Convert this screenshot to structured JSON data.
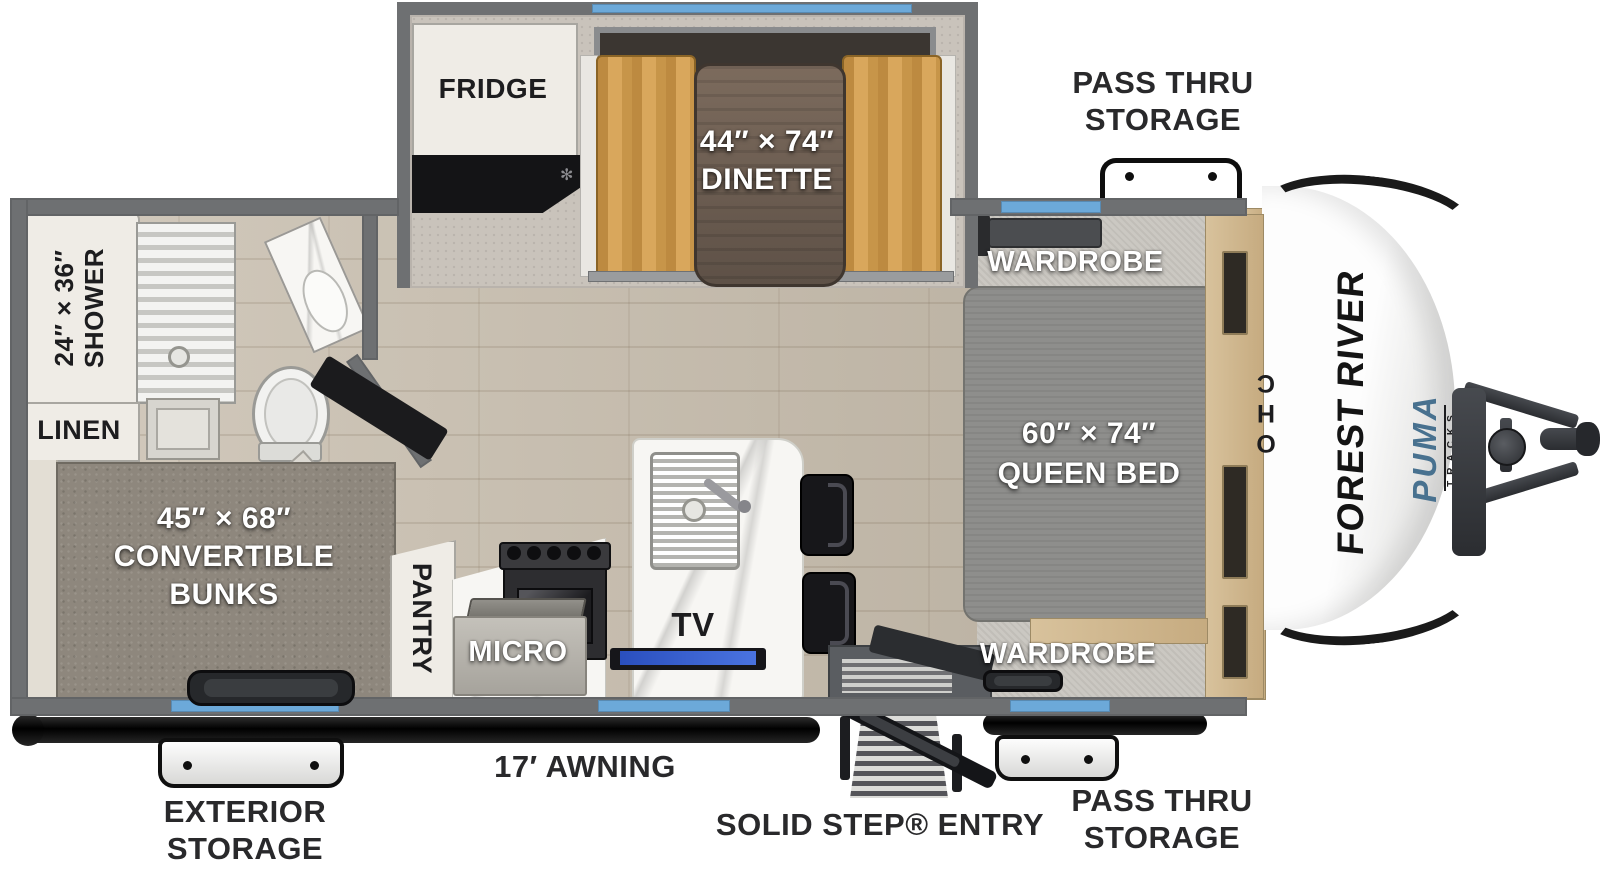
{
  "branding": {
    "manufacturer": "FOREST RIVER",
    "model": "PUMA",
    "series": "TRACKS"
  },
  "exterior": {
    "pass_thru_top": {
      "line1": "PASS THRU",
      "line2": "STORAGE"
    },
    "exterior_storage": {
      "line1": "EXTERIOR",
      "line2": "STORAGE"
    },
    "awning": "17′ AWNING",
    "entry": "SOLID STEP® ENTRY",
    "pass_thru_bottom": {
      "line1": "PASS THRU",
      "line2": "STORAGE"
    }
  },
  "interior": {
    "fridge": "FRIDGE",
    "dinette": {
      "size": "44″ × 74″",
      "name": "DINETTE"
    },
    "wardrobe_top": "WARDROBE",
    "wardrobe_bottom": "WARDROBE",
    "queen_bed": {
      "size": "60″ × 74″",
      "name": "QUEEN BED"
    },
    "ohc": "OHC",
    "shower": {
      "size": "24″ × 36″",
      "name": "SHOWER"
    },
    "linen": "LINEN",
    "bunks": {
      "size": "45″ × 68″",
      "line2": "CONVERTIBLE",
      "line3": "BUNKS"
    },
    "pantry": "PANTRY",
    "micro": "MICRO",
    "tv": "TV"
  },
  "icons": {
    "counter_vent": "✻"
  },
  "colors": {
    "window_blue": "#6CA9D9",
    "label_dark": "#29292B",
    "wall_gray": "#6E7072",
    "bench_tan": "#C99A52",
    "puma_blue": "#48718F",
    "tv_blue": "#2B50C4"
  }
}
